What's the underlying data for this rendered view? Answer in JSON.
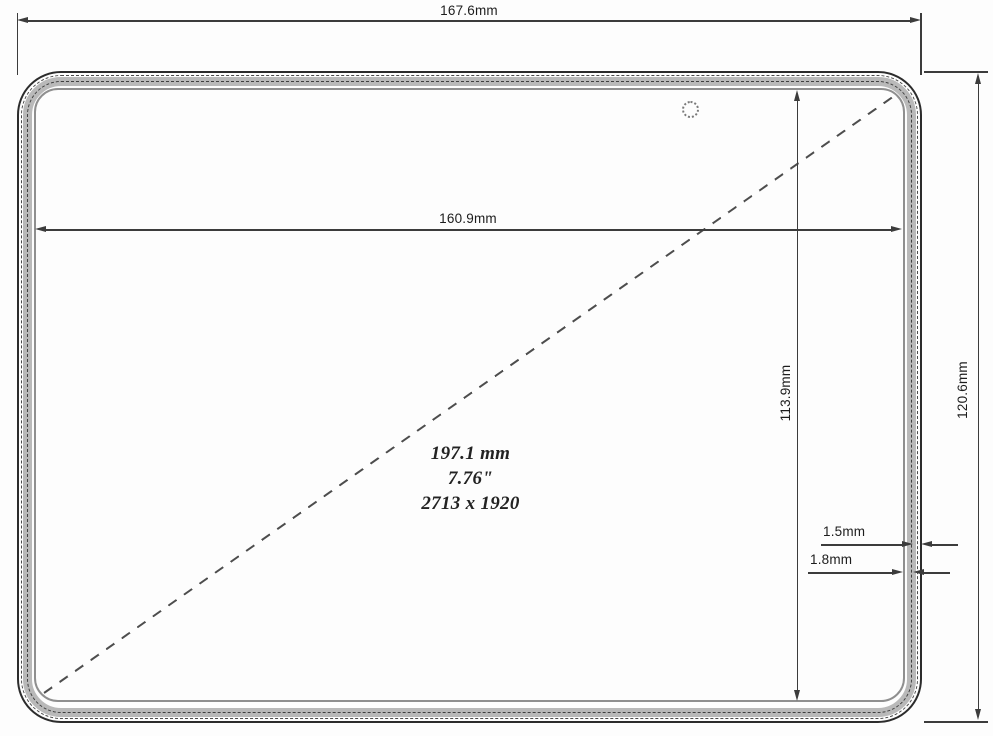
{
  "dimensions": {
    "overall_width": "167.6mm",
    "display_width": "160.9mm",
    "display_height": "113.9mm",
    "overall_height": "120.6mm",
    "bezel_a": "1.5mm",
    "bezel_b": "1.8mm"
  },
  "display_info": {
    "diagonal_mm": "197.1 mm",
    "diagonal_inches": "7.76\"",
    "resolution": "2713 x 1920"
  },
  "colors": {
    "line": "#3c3c3c",
    "bezel_fill": "#b9b9b9",
    "background": "#fdfdfd"
  }
}
